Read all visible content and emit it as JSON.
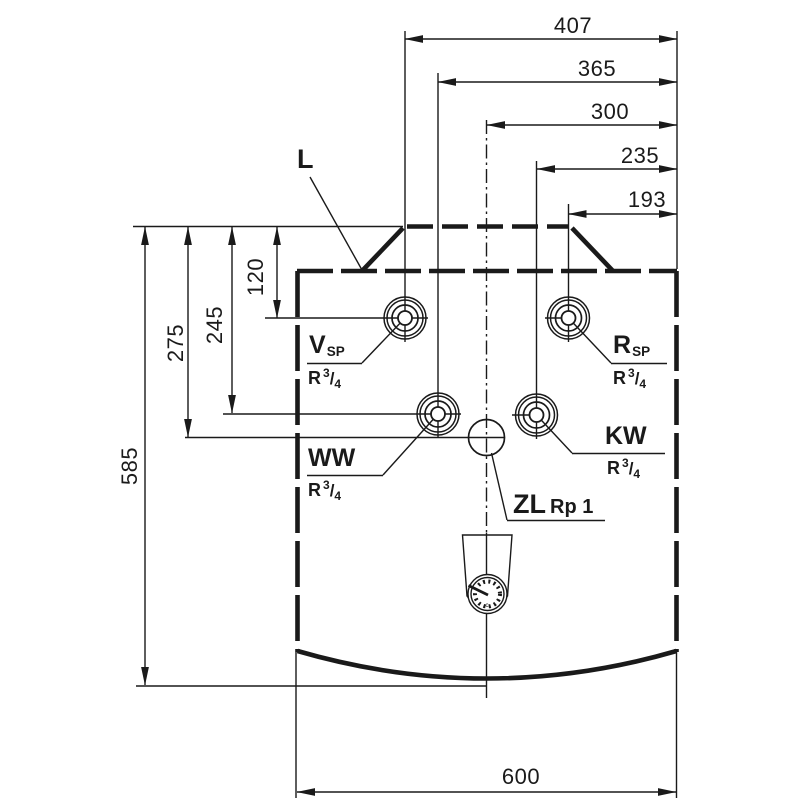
{
  "drawing_title": "appliance-connection-dimensions",
  "dimensions": {
    "top": [
      "407",
      "365",
      "300",
      "235",
      "193"
    ],
    "left": [
      "120",
      "245",
      "275",
      "585"
    ],
    "bottom": [
      "600"
    ]
  },
  "labels": {
    "l": "L"
  },
  "ports": {
    "vsp": {
      "name": "V",
      "sub": "SP"
    },
    "rsp": {
      "name": "R",
      "sub": "SP"
    },
    "ww": {
      "name": "WW"
    },
    "kw": {
      "name": "KW"
    },
    "zl": {
      "name": "ZL",
      "size": "Rp 1"
    }
  },
  "thread_r34": {
    "base": "R",
    "sup": "3",
    "slash": "/",
    "sub": "4"
  },
  "gauge": {
    "mark": "c"
  },
  "colors": {
    "ink": "#1a1a1a",
    "background": "#ffffff"
  }
}
